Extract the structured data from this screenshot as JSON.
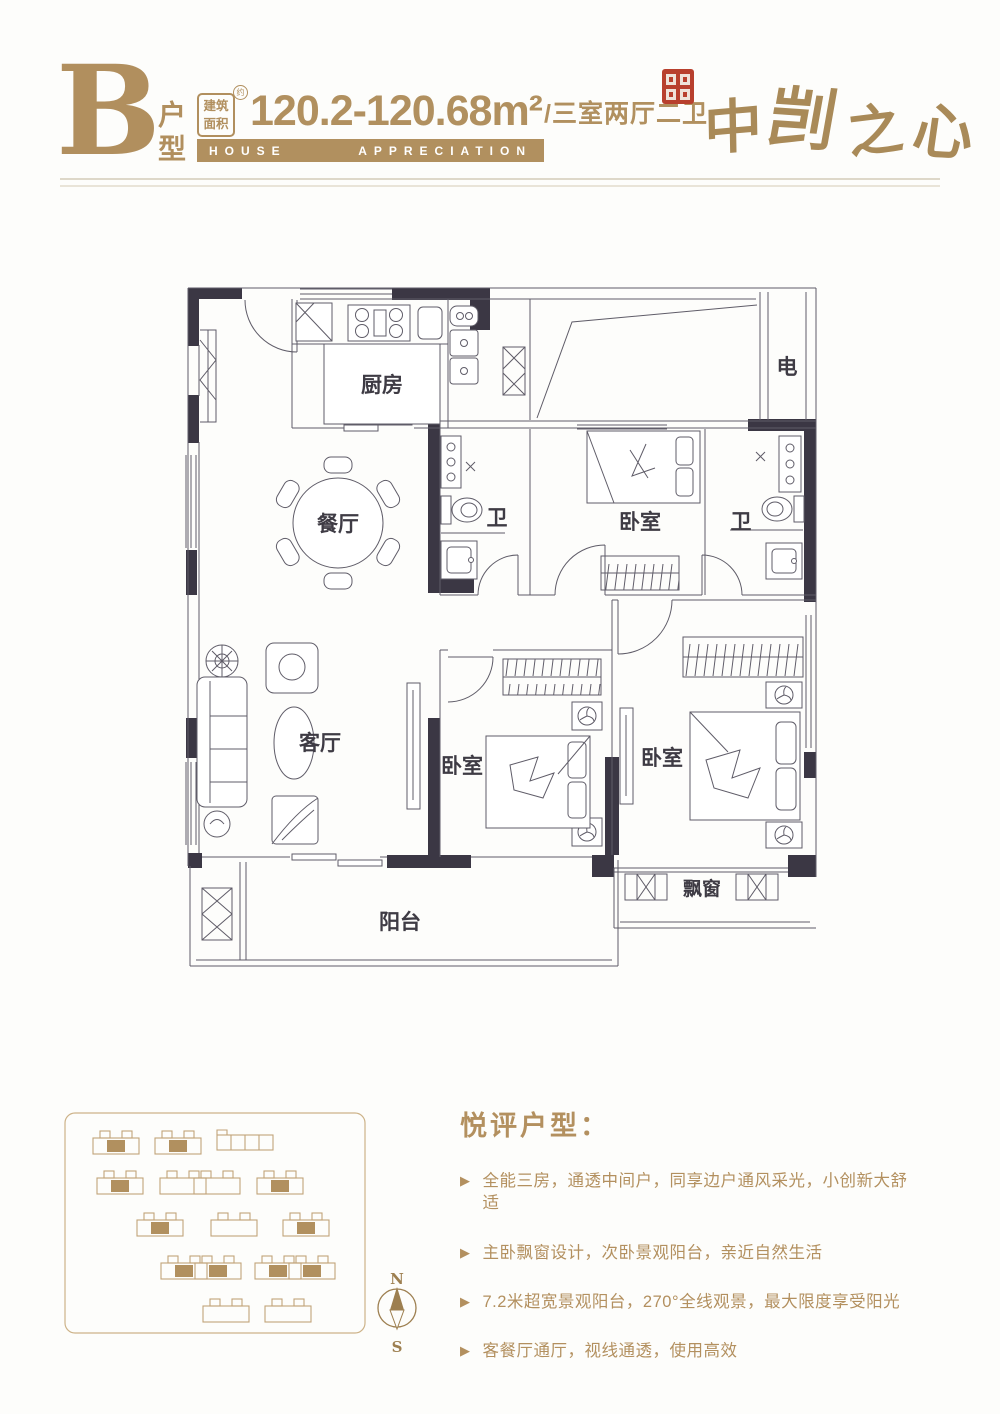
{
  "header": {
    "type_letter": "B",
    "type_label": "户型",
    "area_badge": "建筑面积",
    "area_badge_mark": "约",
    "area_value": "120.2-120.68m²",
    "area_suffix": "/三室两厅二卫",
    "banner_word1": "HOUSE",
    "banner_word2": "APPRECIATION",
    "brand_chars": [
      "中",
      "剀",
      "之",
      "心"
    ]
  },
  "floorplan": {
    "rooms": [
      {
        "id": "kitchen",
        "label": "厨房"
      },
      {
        "id": "dining",
        "label": "餐厅"
      },
      {
        "id": "bath-left",
        "label": "卫"
      },
      {
        "id": "bedroom-top",
        "label": "卧室"
      },
      {
        "id": "bath-right",
        "label": "卫"
      },
      {
        "id": "utility-shaft",
        "label": "电"
      },
      {
        "id": "living",
        "label": "客厅"
      },
      {
        "id": "bedroom-middle",
        "label": "卧室"
      },
      {
        "id": "bedroom-master",
        "label": "卧室"
      },
      {
        "id": "balcony",
        "label": "阳台"
      },
      {
        "id": "bay-window",
        "label": "飘窗"
      }
    ]
  },
  "compass": {
    "north": "N",
    "south": "S"
  },
  "features": {
    "title": "悦评户型：",
    "bullet": "▶",
    "items": [
      "全能三房，通透中间户，同享边户通风采光，小创新大舒适",
      "主卧飘窗设计，次卧景观阳台，亲近自然生活",
      "7.2米超宽景观阳台，270°全线观景，最大限度享受阳光",
      "客餐厅通厅，视线通透，使用高效"
    ]
  },
  "colors": {
    "gold": "#b1905f",
    "wall": "#3b3744",
    "line": "#5f5c68",
    "seal_red": "#b8402e"
  }
}
